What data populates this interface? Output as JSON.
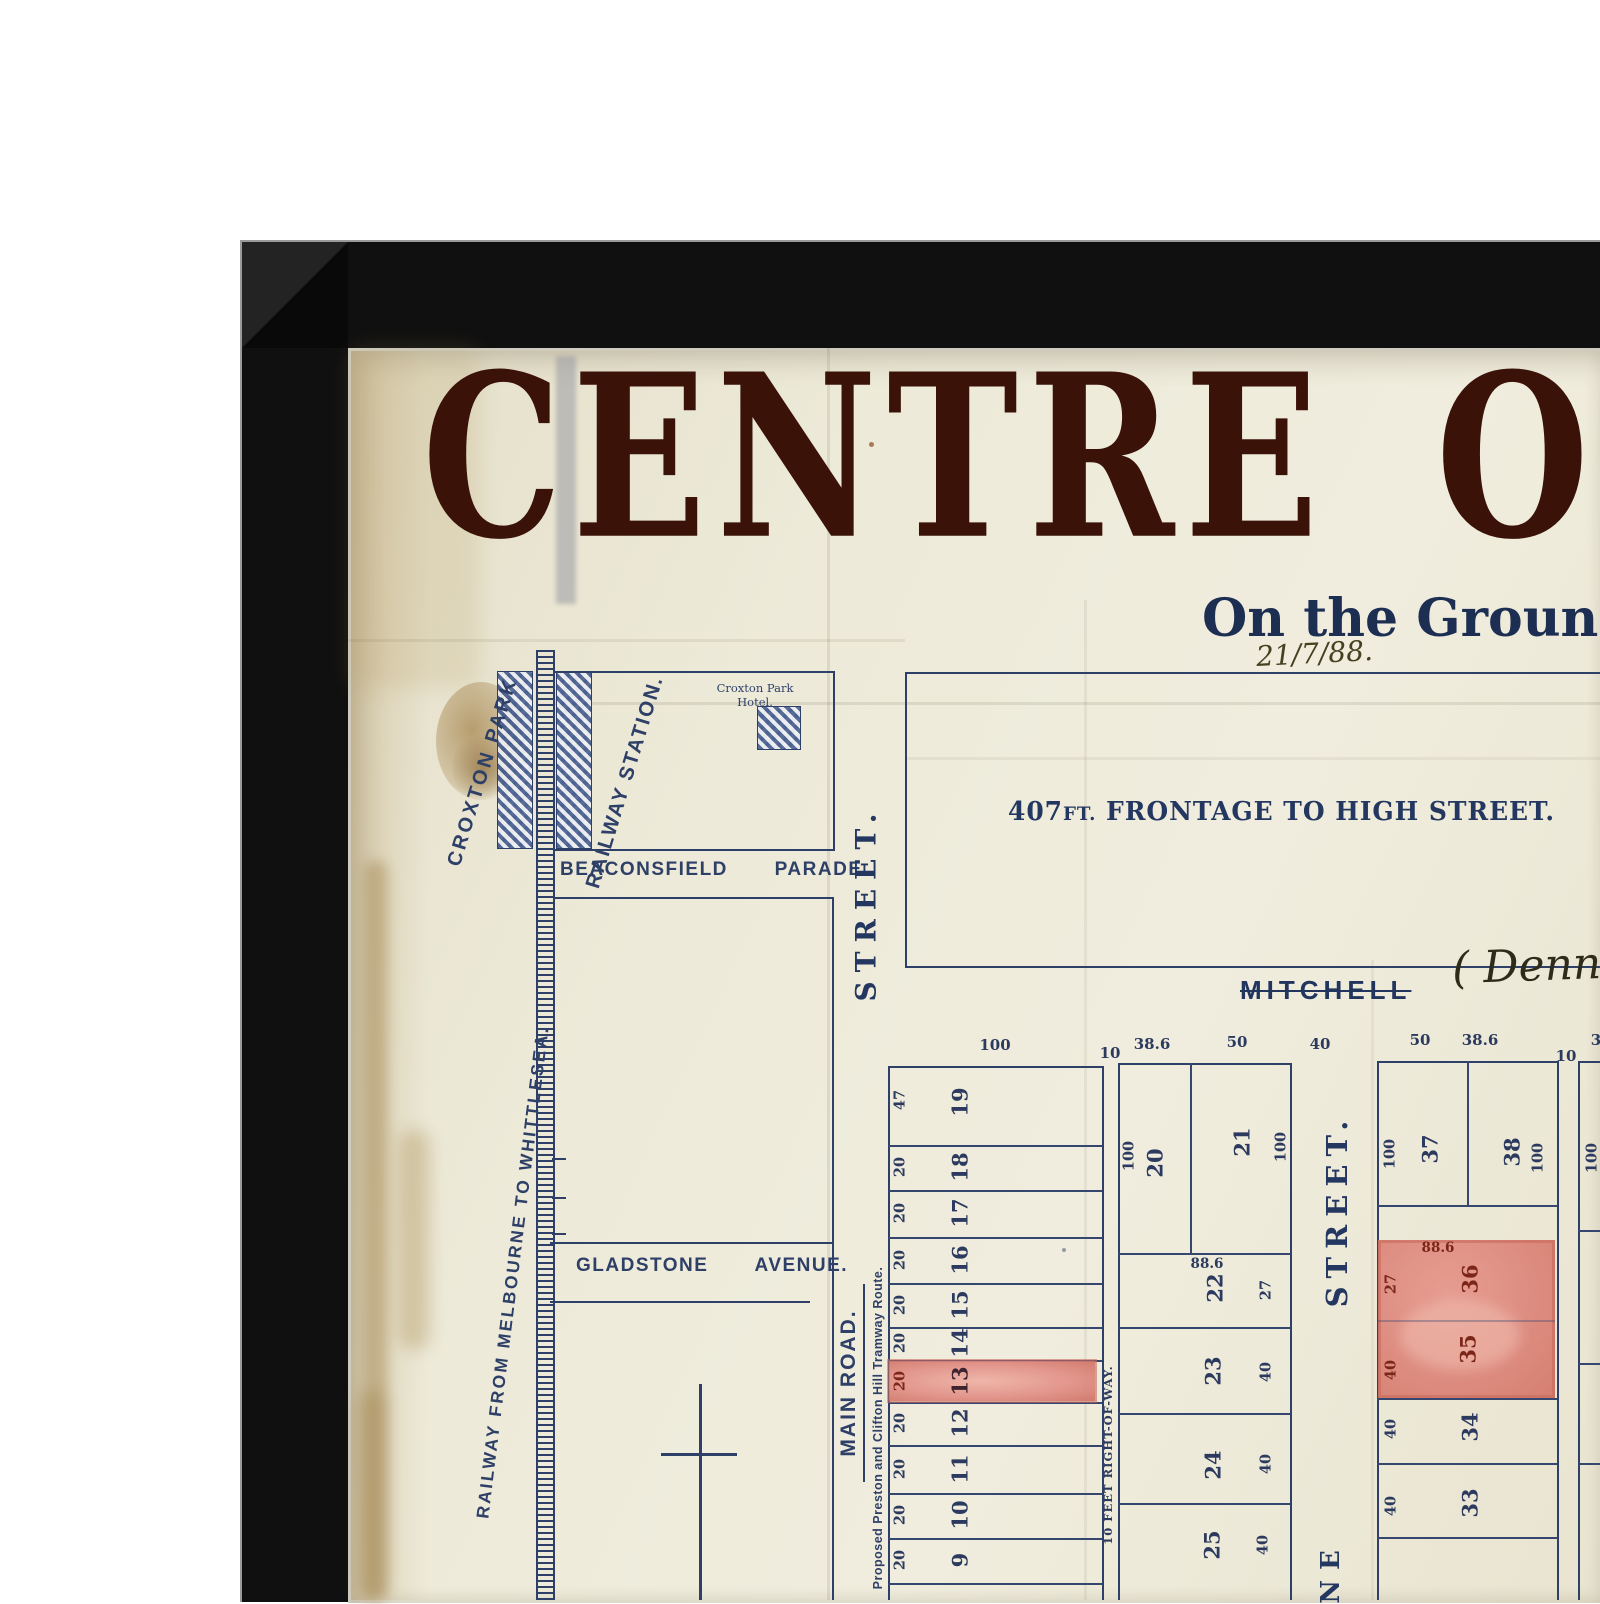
{
  "artwork": {
    "headline": "CENTRE OF",
    "subtitle": "On the Ground",
    "handwritten_date": "21/7/88.",
    "frontage": {
      "number": "407",
      "unit": "FT.",
      "rest": " FRONTAGE TO HIGH STREET."
    },
    "mitchell_printed": "MITCHELL",
    "mitchell_handwritten": "( Dennis"
  },
  "labels": {
    "croxton_park": "CROXTON PARK",
    "railway_station": "RAILWAY STATION.",
    "hotel_line1": "Croxton Park",
    "hotel_line2": "Hotel.",
    "beaconsfield_parade": "BEACONSFIELD  PARADE.",
    "gladstone_avenue": "GLADSTONE  AVENUE.",
    "railway_route": "RAILWAY FROM MELBOURNE TO WHITTLESEA.",
    "main_road": "MAIN ROAD.",
    "tramway_route": "Proposed Preston and Clifton Hill Tramway Route.",
    "right_of_way": "10 FEET RIGHT-OF-WAY.",
    "high_street_label": "STREET.",
    "cross_street_label": "STREET.",
    "cross_street_partial": "NE"
  },
  "measurements": {
    "left_width": "100",
    "gap_left": "10",
    "mid_w1": "38.6",
    "mid_w2": "50",
    "street_width": "40",
    "right_w1": "50",
    "right_w2": "38.6",
    "gap_right": "10",
    "far_partial": "3",
    "far_depth": "100"
  },
  "lots": {
    "left": [
      {
        "n": "19",
        "side": "47"
      },
      {
        "n": "18",
        "side": "20"
      },
      {
        "n": "17",
        "side": "20"
      },
      {
        "n": "16",
        "side": "20"
      },
      {
        "n": "15",
        "side": "20"
      },
      {
        "n": "14",
        "side": "20"
      },
      {
        "n": "13",
        "side": "20"
      },
      {
        "n": "12",
        "side": "20"
      },
      {
        "n": "11",
        "side": "20"
      },
      {
        "n": "10",
        "side": "20"
      },
      {
        "n": "9",
        "side": "20"
      }
    ],
    "middle": [
      {
        "n": "20",
        "depth": "100"
      },
      {
        "n": "21",
        "depth": "100"
      },
      {
        "n": "22",
        "top": "88.6",
        "side": "27"
      },
      {
        "n": "23",
        "side": "40"
      },
      {
        "n": "24",
        "side": "40"
      },
      {
        "n": "25",
        "side": "40"
      }
    ],
    "right": [
      {
        "n": "37",
        "depth": "100"
      },
      {
        "n": "38",
        "depth": "100"
      },
      {
        "n": "36",
        "top": "88.6",
        "side": "27"
      },
      {
        "n": "35",
        "side": "40"
      },
      {
        "n": "34",
        "side": "40"
      },
      {
        "n": "33",
        "side": "40"
      }
    ]
  },
  "colors": {
    "ink_blue": "#2e4067",
    "headline_maroon": "#3a1208",
    "pink_wash": "#e29086",
    "dark_red_label": "#7c2619",
    "paper": "#ece8d7",
    "frame": "#101010"
  }
}
